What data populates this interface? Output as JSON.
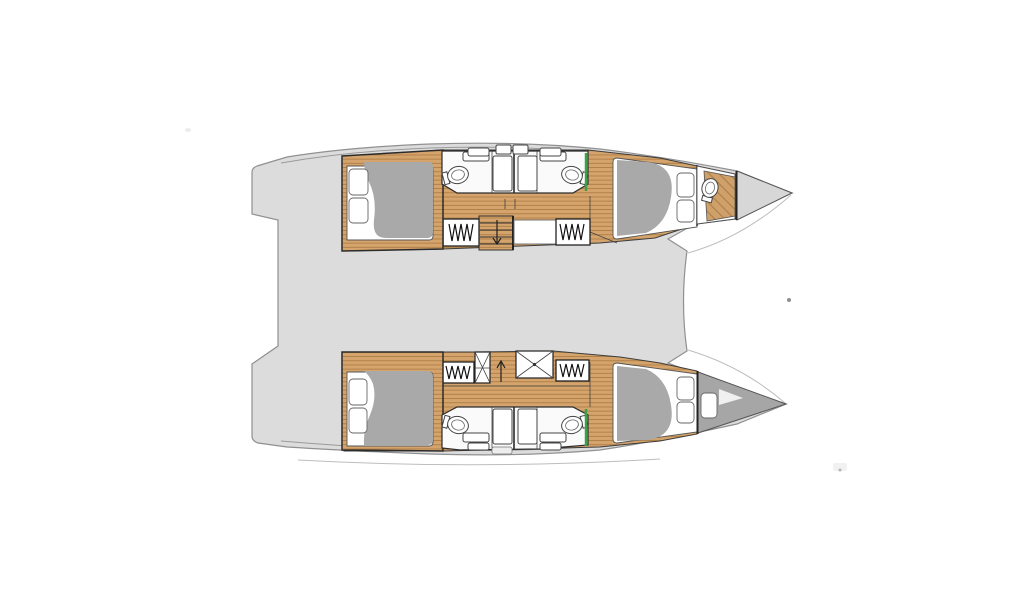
{
  "page": {
    "title": "Catamaran accommodation layout",
    "background": "#ffffff"
  },
  "diagram": {
    "type": "boat-floorplan",
    "vessel": "sailing catamaran",
    "view": "overhead accommodation plan",
    "aria_label": "Overhead accommodation plan of a four-cabin sailing catamaran, bows pointing right",
    "orientation": {
      "bow": "right",
      "stern": "left"
    },
    "layout_summary": "4 double cabins, 4 bathrooms, companionway stairs in each hull, forepeak head to starboard and forepeak berth to port",
    "colors": {
      "background": "#ffffff",
      "bridge_deck": "#dcdcdc",
      "deck_outline": "#909090",
      "interior_line": "#2b2b2b",
      "wood_floor": "#d5a36c",
      "wood_plank_line": "#a5793f",
      "bed_duvet": "#a9a9a9",
      "mattress": "#ffffff",
      "bow_locker": "#d7d7d7",
      "forepeak_berth": "#a6a6a6",
      "accent_green": "#3aa24d"
    },
    "bridge_deck": {
      "name": "bridge deck platform",
      "features": [
        "twin stepped transoms aft",
        "recessed cockpit edge",
        "curved forward crossbeam edge",
        "anchor fitting dot forward"
      ]
    },
    "hulls": [
      {
        "id": "upper-hull",
        "position": "top",
        "rooms": [
          {
            "name": "aft-cabin",
            "furniture": [
              "double-berth",
              "two-pillows",
              "gray-duvet",
              "wood-floor"
            ]
          },
          {
            "name": "bathroom-aft",
            "fixtures": [
              "toilet",
              "sink-counter",
              "shower-stall",
              "hull-window"
            ]
          },
          {
            "name": "bathroom-forward",
            "fixtures": [
              "toilet",
              "sink-counter",
              "shower-stall",
              "hull-window"
            ]
          },
          {
            "name": "roof-hatches",
            "count": 2
          },
          {
            "name": "wardrobe-aft",
            "symbol": "hanging-clothes"
          },
          {
            "name": "wardrobe-forward",
            "symbol": "hanging-clothes"
          },
          {
            "name": "companionway-stairs",
            "symbol": "steps-with-down-arrow"
          },
          {
            "name": "vanity-locker"
          },
          {
            "name": "forward-cabin",
            "furniture": [
              "double-berth",
              "two-pillows",
              "gray-duvet"
            ]
          },
          {
            "name": "forepeak-head",
            "fixtures": [
              "toilet",
              "diagonal-wood-floor"
            ]
          },
          {
            "name": "bow-locker"
          }
        ]
      },
      {
        "id": "lower-hull",
        "position": "bottom",
        "rooms": [
          {
            "name": "aft-cabin",
            "furniture": [
              "double-berth",
              "two-pillows",
              "gray-duvet",
              "wood-floor"
            ]
          },
          {
            "name": "bathroom-aft",
            "fixtures": [
              "toilet",
              "sink-counter",
              "shower-stall",
              "hull-window"
            ]
          },
          {
            "name": "bathroom-forward",
            "fixtures": [
              "toilet",
              "sink-counter",
              "shower-stall",
              "hull-window"
            ]
          },
          {
            "name": "deck-hatch-narrow",
            "symbol": "x-cross"
          },
          {
            "name": "deck-hatch-large",
            "symbol": "x-cross"
          },
          {
            "name": "wardrobe-aft",
            "symbol": "hanging-clothes"
          },
          {
            "name": "wardrobe-forward",
            "symbol": "hanging-clothes"
          },
          {
            "name": "companionway-stairs",
            "symbol": "up-arrow"
          },
          {
            "name": "forward-cabin",
            "furniture": [
              "double-berth",
              "two-pillows",
              "gray-duvet"
            ]
          },
          {
            "name": "forepeak-berth",
            "furniture": [
              "gray-berth",
              "pillow"
            ]
          }
        ]
      }
    ]
  }
}
